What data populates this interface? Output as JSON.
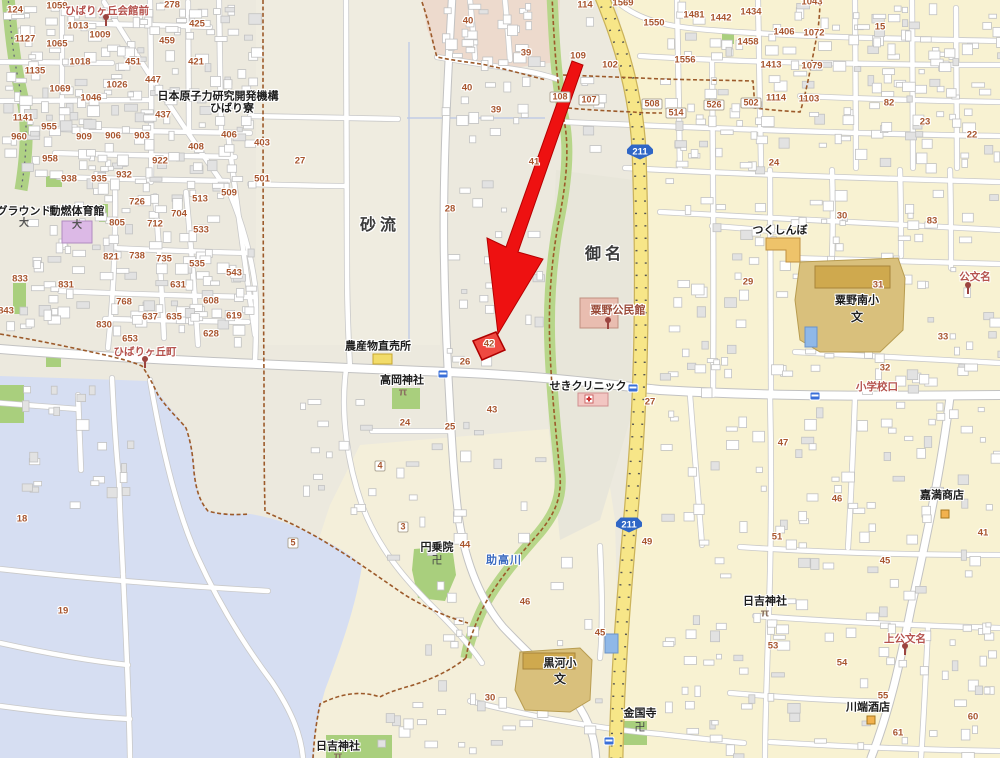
{
  "map": {
    "colors": {
      "arrow": "#ee1111",
      "parcel_fill": "#ef3b33",
      "parcel_stroke": "#b00000",
      "route_road": "#f7e688",
      "water": "#d6def2",
      "green": "#a9cf7d",
      "shield_blue": "#2f66c6",
      "number_text": "#a8552e",
      "bus_stop_text": "#b5524d",
      "cream_zone": "#f8f2d2",
      "base": "#ece9de"
    },
    "area_labels": [
      {
        "text": "砂流",
        "x": 380,
        "y": 226
      },
      {
        "text": "御名",
        "x": 605,
        "y": 255
      }
    ],
    "poi_labels": [
      {
        "text": "日本原子力研究開発機構",
        "x": 218,
        "y": 97
      },
      {
        "text": "ひばり寮",
        "x": 232,
        "y": 109
      },
      {
        "text": "グラウンド",
        "x": 24,
        "y": 212
      },
      {
        "text": "動燃体育館",
        "x": 77,
        "y": 212
      },
      {
        "text": "農産物直売所",
        "x": 378,
        "y": 347
      },
      {
        "text": "高岡神社",
        "x": 402,
        "y": 381
      },
      {
        "text": "せきクリニック",
        "x": 588,
        "y": 387
      },
      {
        "text": "つくしんぼ",
        "x": 780,
        "y": 231
      },
      {
        "text": "粟野南小",
        "x": 857,
        "y": 301
      },
      {
        "text": "黒河小",
        "x": 560,
        "y": 664
      },
      {
        "text": "円乗院",
        "x": 437,
        "y": 548
      },
      {
        "text": "金国寺",
        "x": 640,
        "y": 714
      },
      {
        "text": "日吉神社",
        "x": 338,
        "y": 747
      },
      {
        "text": "日吉神社",
        "x": 765,
        "y": 602
      },
      {
        "text": "川端酒店",
        "x": 868,
        "y": 708
      },
      {
        "text": "嘉満商店",
        "x": 942,
        "y": 496
      }
    ],
    "poi_red_labels": [
      {
        "text": "粟野公民館",
        "x": 618,
        "y": 311
      }
    ],
    "bus_stop_labels": [
      {
        "text": "ひばりヶ丘会館前",
        "x": 107,
        "y": 11
      },
      {
        "text": "ひばりヶ丘町",
        "x": 145,
        "y": 352
      },
      {
        "text": "上公文名",
        "x": 905,
        "y": 639
      },
      {
        "text": "公文名",
        "x": 975,
        "y": 277
      },
      {
        "text": "小学校口",
        "x": 877,
        "y": 387
      }
    ],
    "river_label": {
      "text": "助高川",
      "x": 504,
      "y": 561
    },
    "route_shields": [
      {
        "text": "211",
        "x": 640,
        "y": 152
      },
      {
        "text": "211",
        "x": 629,
        "y": 525
      }
    ],
    "highlight": {
      "parcel_number": "42",
      "parcel_x": 489,
      "parcel_y": 345
    },
    "house_numbers": [
      [
        57,
        6,
        "1059"
      ],
      [
        15,
        10,
        "124"
      ],
      [
        172,
        5,
        "278"
      ],
      [
        197,
        24,
        "425"
      ],
      [
        78,
        26,
        "1013"
      ],
      [
        100,
        35,
        "1009"
      ],
      [
        25,
        39,
        "1127"
      ],
      [
        57,
        44,
        "1065"
      ],
      [
        167,
        41,
        "459"
      ],
      [
        80,
        62,
        "1018"
      ],
      [
        133,
        62,
        "451"
      ],
      [
        196,
        62,
        "421"
      ],
      [
        35,
        71,
        "1135"
      ],
      [
        153,
        80,
        "447"
      ],
      [
        117,
        85,
        "1026"
      ],
      [
        60,
        89,
        "1069"
      ],
      [
        91,
        98,
        "1046"
      ],
      [
        163,
        115,
        "437"
      ],
      [
        23,
        118,
        "1141"
      ],
      [
        49,
        127,
        "955"
      ],
      [
        19,
        137,
        "960"
      ],
      [
        84,
        137,
        "909"
      ],
      [
        113,
        136,
        "906"
      ],
      [
        142,
        136,
        "903"
      ],
      [
        229,
        135,
        "406"
      ],
      [
        196,
        147,
        "408"
      ],
      [
        50,
        159,
        "958"
      ],
      [
        160,
        161,
        "922"
      ],
      [
        69,
        179,
        "938"
      ],
      [
        99,
        179,
        "935"
      ],
      [
        124,
        175,
        "932"
      ],
      [
        229,
        193,
        "509"
      ],
      [
        200,
        199,
        "513"
      ],
      [
        137,
        202,
        "726"
      ],
      [
        179,
        214,
        "704"
      ],
      [
        117,
        223,
        "805"
      ],
      [
        155,
        224,
        "712"
      ],
      [
        201,
        230,
        "533"
      ],
      [
        111,
        257,
        "821"
      ],
      [
        137,
        256,
        "738"
      ],
      [
        164,
        259,
        "735"
      ],
      [
        197,
        264,
        "535"
      ],
      [
        234,
        273,
        "543"
      ],
      [
        20,
        279,
        "833"
      ],
      [
        66,
        285,
        "831"
      ],
      [
        178,
        285,
        "631"
      ],
      [
        211,
        301,
        "608"
      ],
      [
        6,
        311,
        "843"
      ],
      [
        124,
        302,
        "768"
      ],
      [
        150,
        317,
        "637"
      ],
      [
        174,
        317,
        "635"
      ],
      [
        234,
        316,
        "619"
      ],
      [
        104,
        325,
        "830"
      ],
      [
        130,
        339,
        "653"
      ],
      [
        211,
        334,
        "628"
      ],
      [
        262,
        143,
        "403"
      ],
      [
        300,
        161,
        "27"
      ],
      [
        262,
        179,
        "501"
      ],
      [
        468,
        21,
        "40"
      ],
      [
        526,
        53,
        "39"
      ],
      [
        467,
        88,
        "40"
      ],
      [
        496,
        110,
        "39"
      ],
      [
        534,
        162,
        "41"
      ],
      [
        450,
        209,
        "28"
      ],
      [
        585,
        5,
        "114"
      ],
      [
        623,
        3,
        "1569"
      ],
      [
        654,
        23,
        "1550"
      ],
      [
        694,
        15,
        "1481"
      ],
      [
        721,
        18,
        "1442"
      ],
      [
        751,
        12,
        "1434"
      ],
      [
        784,
        32,
        "1406"
      ],
      [
        748,
        42,
        "1458"
      ],
      [
        685,
        60,
        "1556"
      ],
      [
        771,
        65,
        "1413"
      ],
      [
        578,
        56,
        "109"
      ],
      [
        610,
        65,
        "102"
      ],
      [
        776,
        98,
        "1114"
      ],
      [
        774,
        163,
        "24"
      ],
      [
        812,
        2,
        "1043"
      ],
      [
        814,
        33,
        "1072"
      ],
      [
        812,
        66,
        "1079"
      ],
      [
        809,
        99,
        "1103"
      ],
      [
        880,
        27,
        "15"
      ],
      [
        889,
        103,
        "82"
      ],
      [
        925,
        122,
        "23"
      ],
      [
        972,
        135,
        "22"
      ],
      [
        748,
        282,
        "29"
      ],
      [
        842,
        216,
        "30"
      ],
      [
        932,
        221,
        "83"
      ],
      [
        878,
        285,
        "31"
      ],
      [
        943,
        337,
        "33"
      ],
      [
        885,
        368,
        "32"
      ],
      [
        465,
        362,
        "26"
      ],
      [
        489,
        344,
        "42"
      ],
      [
        492,
        410,
        "43"
      ],
      [
        405,
        423,
        "24"
      ],
      [
        450,
        427,
        "25"
      ],
      [
        650,
        402,
        "27"
      ],
      [
        465,
        545,
        "44"
      ],
      [
        525,
        602,
        "46"
      ],
      [
        600,
        633,
        "45"
      ],
      [
        490,
        698,
        "30"
      ],
      [
        647,
        542,
        "49"
      ],
      [
        783,
        443,
        "47"
      ],
      [
        837,
        499,
        "46"
      ],
      [
        777,
        537,
        "51"
      ],
      [
        885,
        561,
        "45"
      ],
      [
        983,
        533,
        "41"
      ],
      [
        773,
        646,
        "53"
      ],
      [
        842,
        663,
        "54"
      ],
      [
        883,
        696,
        "55"
      ],
      [
        973,
        717,
        "60"
      ],
      [
        898,
        733,
        "61"
      ],
      [
        22,
        519,
        "18"
      ],
      [
        63,
        611,
        "19"
      ]
    ],
    "plate_numbers": [
      [
        589,
        100,
        "107"
      ],
      [
        560,
        97,
        "108"
      ],
      [
        652,
        104,
        "508"
      ],
      [
        676,
        113,
        "514"
      ],
      [
        714,
        105,
        "526"
      ],
      [
        751,
        103,
        "502"
      ],
      [
        403,
        527,
        "3"
      ],
      [
        380,
        466,
        "4"
      ],
      [
        293,
        543,
        "5"
      ]
    ],
    "icons": [
      {
        "type": "torii",
        "x": 403,
        "y": 393
      },
      {
        "type": "torii",
        "x": 765,
        "y": 614
      },
      {
        "type": "torii",
        "x": 338,
        "y": 757
      },
      {
        "type": "manji",
        "x": 437,
        "y": 561
      },
      {
        "type": "manji",
        "x": 640,
        "y": 728
      },
      {
        "type": "school",
        "x": 857,
        "y": 317
      },
      {
        "type": "school",
        "x": 560,
        "y": 679
      },
      {
        "type": "sport",
        "x": 24,
        "y": 224
      },
      {
        "type": "sport",
        "x": 77,
        "y": 226
      },
      {
        "type": "pole",
        "x": 106,
        "y": 22
      },
      {
        "type": "pole",
        "x": 145,
        "y": 364
      },
      {
        "type": "pole",
        "x": 608,
        "y": 325
      },
      {
        "type": "pole",
        "x": 968,
        "y": 290
      },
      {
        "type": "pole",
        "x": 905,
        "y": 651
      },
      {
        "type": "bus",
        "x": 443,
        "y": 374
      },
      {
        "type": "bus",
        "x": 633,
        "y": 388
      },
      {
        "type": "bus",
        "x": 815,
        "y": 396
      },
      {
        "type": "bus",
        "x": 609,
        "y": 741
      },
      {
        "type": "store",
        "x": 945,
        "y": 514
      },
      {
        "type": "store",
        "x": 871,
        "y": 720
      }
    ]
  }
}
